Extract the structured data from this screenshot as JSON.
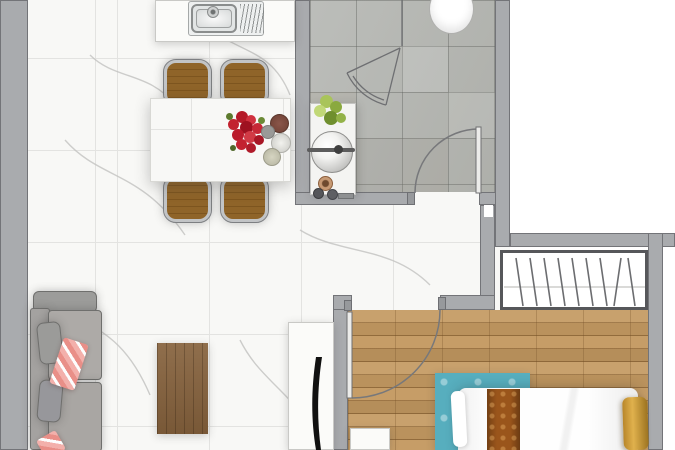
{
  "canvas": {
    "width": 675,
    "height": 450,
    "kind": "apartment-floor-plan-top-view",
    "text_labels": []
  },
  "palette": {
    "outside": "#ffffff",
    "wall_fill": "#a9abae",
    "wall_outline": "#737478",
    "marble_floor": "#f8f8f6",
    "marble_grid": "#e3e3e1",
    "bath_tile": "#b4b6b2",
    "wood_floor": "#c49a62",
    "wood_rug": "#86623d",
    "counter_white": "#fbfbf9",
    "chair_wood": "#8f6429",
    "chrome_trim": "#c2c4c6",
    "sofa_gray": "#a8a5a2",
    "throw_pink": "#efa5a0",
    "flower_red": "#c51f2f",
    "plant_green": "#93b248",
    "teal_rug": "#57aebe",
    "bed_white": "#fdfdfd",
    "runner_brown": "#9a551b",
    "pillow_gold": "#c9972f",
    "tv_black": "#111111"
  },
  "rooms": {
    "kitchen_dining": {
      "floor": "white-marble-tile"
    },
    "bathroom": {
      "floor": "gray-stone-tile"
    },
    "hallway": {
      "floor": "white-marble-tile"
    },
    "bedroom": {
      "floor": "oak-plank"
    }
  },
  "furniture": {
    "kitchen": [
      "counter-with-stainless-sink-and-drainboard",
      "faucet"
    ],
    "dining": [
      "white-table",
      "wood-chairs-x4",
      "red-flower-bouquet",
      "plates-x4"
    ],
    "bathroom": [
      "toilet",
      "corner-shower-with-pivot-door",
      "vanity-counter",
      "round-vessel-basin",
      "potted-plant",
      "toiletry-jars"
    ],
    "living": [
      "gray-sofa",
      "gray-cushions-x2",
      "pink-throws-x2",
      "wood-area-rug",
      "tv-console",
      "tv"
    ],
    "bedroom": [
      "wardrobe-with-hanger-symbols",
      "double-bed-white-linen",
      "brown-bed-runner",
      "gold-pillow",
      "teal-damask-rug",
      "white-nightstand"
    ],
    "doors": [
      "bathroom-swing-door",
      "bedroom-swing-door"
    ]
  }
}
